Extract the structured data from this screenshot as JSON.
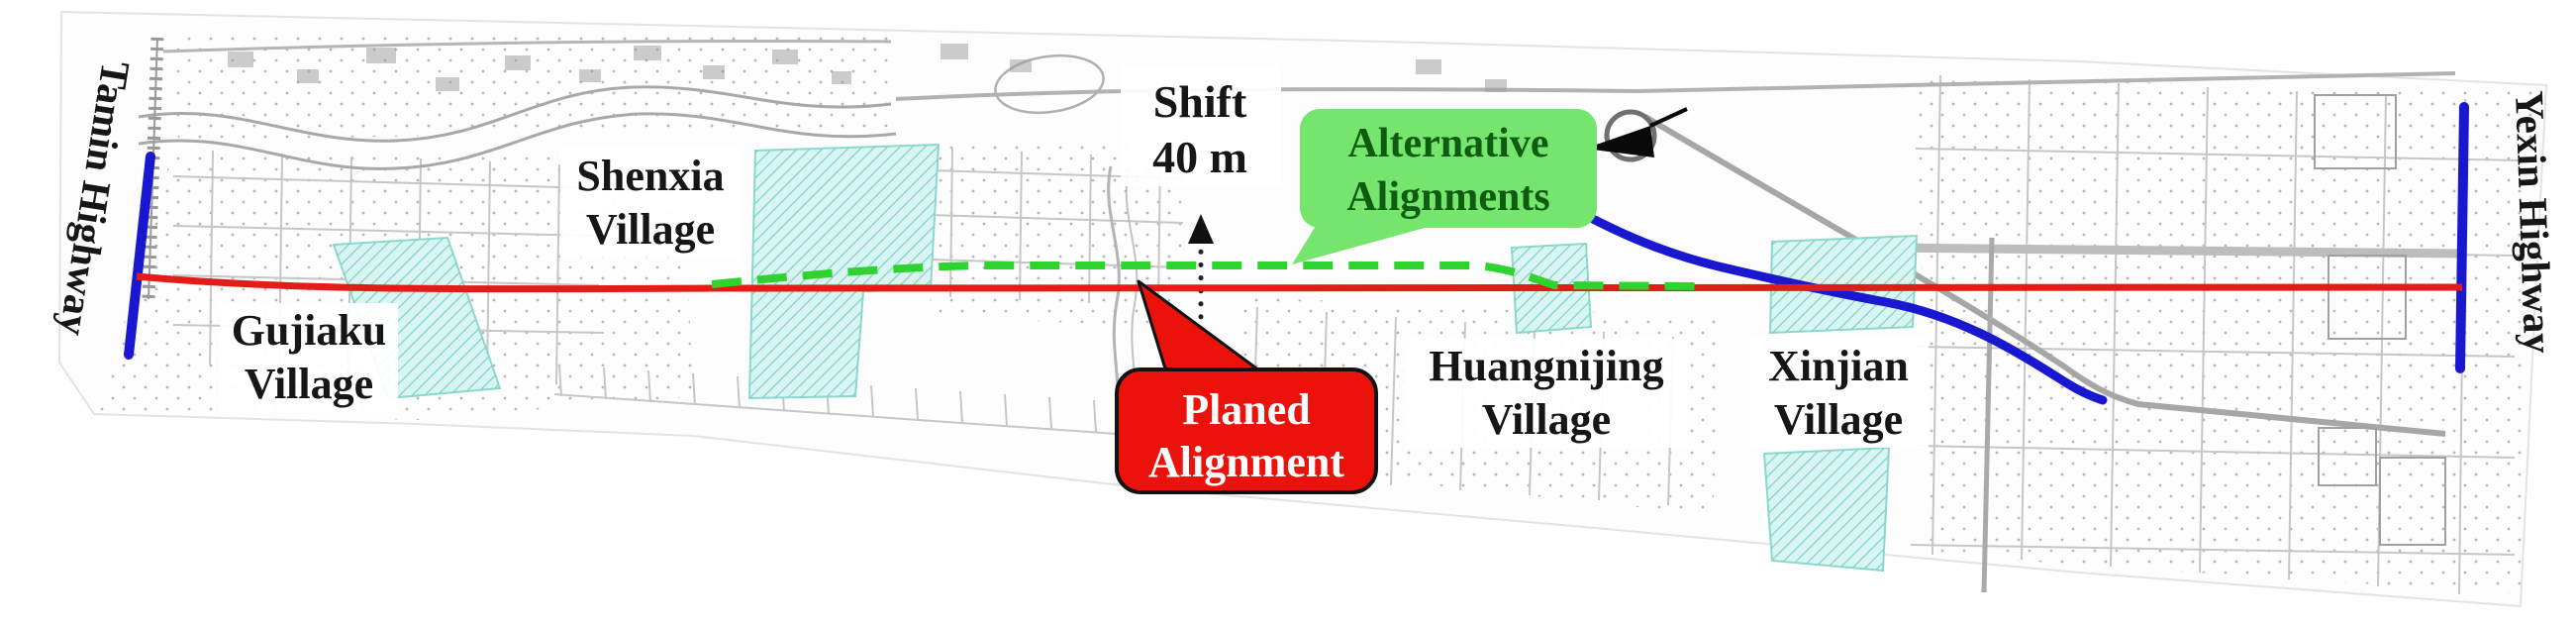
{
  "figure": {
    "type": "highway-alignment-planning-map",
    "highways": {
      "left": "Tamin Highway",
      "right": "Yexin Highway"
    },
    "villages": {
      "shenxia": {
        "line1": "Shenxia",
        "line2": "Village"
      },
      "gujiaku": {
        "line1": "Gujiaku",
        "line2": "Village"
      },
      "huangnijing": {
        "line1": "Huangnijing",
        "line2": "Village"
      },
      "xinjian": {
        "line1": "Xinjian",
        "line2": "Village"
      }
    },
    "annotations": {
      "shift": {
        "line1": "Shift",
        "line2": "40 m"
      },
      "planned": {
        "line1": "Planed",
        "line2": "Alignment"
      },
      "alternative": {
        "line1": "Alternative",
        "line2": "Alignments"
      }
    },
    "colors": {
      "planned_alignment": "#e41c17",
      "alternative_alignment": "#2fd32f",
      "highway": "#1a17d0",
      "planned_callout_fill": "#ea120b",
      "planned_callout_text": "#ffffff",
      "alternative_callout_fill": "#76e56e",
      "alternative_callout_text": "#0e5c10",
      "village_area_fill": "#d8f5f1"
    }
  }
}
